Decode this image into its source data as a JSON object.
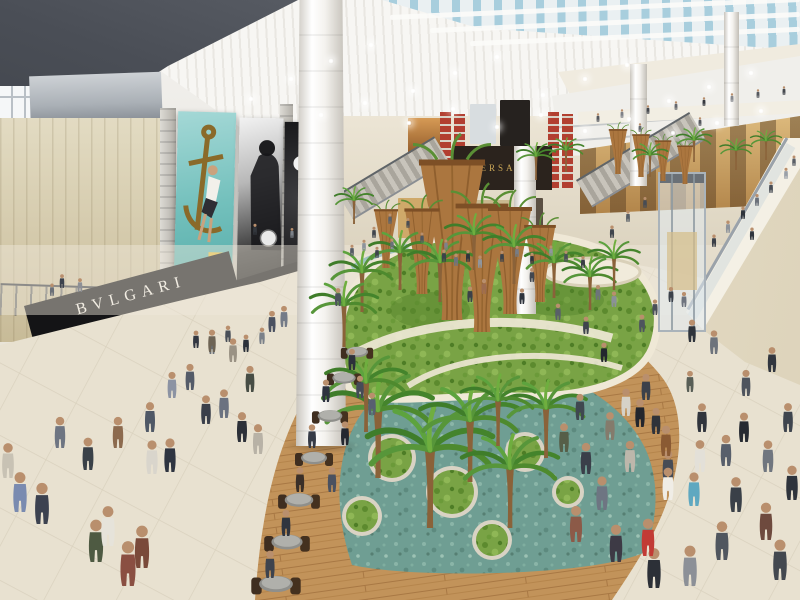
{
  "signs": {
    "bulgari": "BVLGARI",
    "veuve_clicquot": "Veuve Clicquot",
    "versace": "VERSACE"
  },
  "palette": {
    "ceiling_white": "#f4f3f0",
    "skylight_blue": "#a8cedd",
    "wall_beige": "#d9cfae",
    "fascia_black": "#141417",
    "store_glow_gold": "#dcb266",
    "garden_green": "#79a345",
    "water_teal": "#6f9e93",
    "deck_wood": "#c2935a",
    "floor_tile": "#e8e1d0",
    "cone_wood": "#ab763f",
    "versace_gold": "#c9a657",
    "banner_red": "#b23f30",
    "billboard_teal": "#73c0bc"
  },
  "sprites": {
    "lights": [
      [
        248,
        96
      ],
      [
        288,
        76
      ],
      [
        328,
        58
      ],
      [
        368,
        42
      ],
      [
        410,
        88
      ],
      [
        452,
        70
      ],
      [
        494,
        54
      ],
      [
        540,
        92
      ],
      [
        582,
        76
      ],
      [
        624,
        62
      ],
      [
        666,
        98
      ],
      [
        706,
        84
      ],
      [
        748,
        70
      ],
      [
        318,
        112
      ],
      [
        362,
        100
      ],
      [
        406,
        120
      ],
      [
        450,
        106
      ],
      [
        494,
        124
      ],
      [
        538,
        112
      ],
      [
        582,
        128
      ],
      [
        626,
        116
      ],
      [
        670,
        130
      ],
      [
        714,
        120
      ],
      [
        758,
        108
      ]
    ],
    "cones": [
      [
        452,
        320,
        1.5
      ],
      [
        482,
        332,
        1.2
      ],
      [
        510,
        314,
        1.0
      ],
      [
        422,
        294,
        0.8
      ],
      [
        540,
        302,
        0.72
      ],
      [
        386,
        268,
        0.55
      ],
      [
        618,
        174,
        0.42
      ],
      [
        641,
        177,
        0.4
      ],
      [
        663,
        181,
        0.38
      ],
      [
        685,
        184,
        0.36
      ]
    ],
    "palms": [
      [
        378,
        478,
        1.7
      ],
      [
        366,
        432,
        1.25
      ],
      [
        430,
        528,
        1.95
      ],
      [
        470,
        482,
        1.55
      ],
      [
        510,
        528,
        1.5
      ],
      [
        546,
        458,
        1.25
      ],
      [
        498,
        446,
        1.15
      ],
      [
        362,
        312,
        1.0
      ],
      [
        400,
        290,
        0.95
      ],
      [
        440,
        302,
        1.0
      ],
      [
        474,
        270,
        0.9
      ],
      [
        514,
        284,
        0.95
      ],
      [
        554,
        298,
        0.9
      ],
      [
        590,
        310,
        0.85
      ],
      [
        614,
        290,
        0.8
      ],
      [
        344,
        347,
        1.05
      ],
      [
        536,
        180,
        0.6
      ],
      [
        566,
        172,
        0.55
      ],
      [
        650,
        177,
        0.55
      ],
      [
        694,
        162,
        0.55
      ],
      [
        736,
        170,
        0.5
      ],
      [
        354,
        224,
        0.6
      ],
      [
        766,
        160,
        0.48
      ]
    ],
    "tables": [
      [
        357,
        352,
        0.85
      ],
      [
        344,
        378,
        0.9
      ],
      [
        330,
        416,
        0.95
      ],
      [
        314,
        458,
        1.0
      ],
      [
        299,
        500,
        1.1
      ],
      [
        287,
        542,
        1.2
      ],
      [
        276,
        584,
        1.3
      ]
    ],
    "people": [
      [
        62,
        288,
        0.55,
        "#3c424d"
      ],
      [
        80,
        292,
        0.55,
        "#8d8f95"
      ],
      [
        52,
        296,
        0.5,
        "#6b7078"
      ],
      [
        255,
        235,
        0.45,
        "#33373d"
      ],
      [
        408,
        228,
        0.4,
        "#4a4e54"
      ],
      [
        292,
        238,
        0.4,
        "#7c8188"
      ],
      [
        598,
        122,
        0.35,
        "#55585e"
      ],
      [
        622,
        118,
        0.35,
        "#7e8187"
      ],
      [
        648,
        114,
        0.35,
        "#45484e"
      ],
      [
        676,
        110,
        0.35,
        "#65686e"
      ],
      [
        704,
        106,
        0.35,
        "#35383e"
      ],
      [
        732,
        102,
        0.35,
        "#85888e"
      ],
      [
        758,
        98,
        0.35,
        "#55585e"
      ],
      [
        784,
        95,
        0.35,
        "#45484e"
      ],
      [
        640,
        132,
        0.35,
        "#666a70"
      ],
      [
        700,
        126,
        0.35,
        "#54575d"
      ],
      [
        714,
        247,
        0.5,
        "#3a3f47"
      ],
      [
        728,
        233,
        0.5,
        "#8d939b"
      ],
      [
        743,
        219,
        0.5,
        "#2e333b"
      ],
      [
        757,
        206,
        0.48,
        "#6a707a"
      ],
      [
        771,
        193,
        0.46,
        "#484d55"
      ],
      [
        786,
        179,
        0.45,
        "#9aa0a8"
      ],
      [
        752,
        240,
        0.5,
        "#30353d"
      ],
      [
        794,
        166,
        0.42,
        "#5a5f67"
      ],
      [
        352,
        256,
        0.45,
        "#555b64"
      ],
      [
        364,
        251,
        0.45,
        "#8d939b"
      ],
      [
        377,
        258,
        0.45,
        "#3e434b"
      ],
      [
        392,
        249,
        0.42,
        "#6a707a"
      ],
      [
        422,
        243,
        0.42,
        "#50555e"
      ],
      [
        446,
        250,
        0.42,
        "#7d838c"
      ],
      [
        502,
        262,
        0.45,
        "#3c414a"
      ],
      [
        517,
        257,
        0.45,
        "#777d86"
      ],
      [
        532,
        264,
        0.45,
        "#2f343c"
      ],
      [
        551,
        256,
        0.42,
        "#8f959d"
      ],
      [
        566,
        262,
        0.45,
        "#4a4f58"
      ],
      [
        583,
        268,
        0.48,
        "#383d45"
      ],
      [
        374,
        238,
        0.45,
        "#40454d"
      ],
      [
        390,
        224,
        0.42,
        "#5c626a"
      ],
      [
        612,
        238,
        0.5,
        "#3f444c"
      ],
      [
        628,
        222,
        0.46,
        "#585e66"
      ],
      [
        645,
        208,
        0.44,
        "#474c54"
      ],
      [
        671,
        302,
        0.6,
        "#3c424b"
      ],
      [
        684,
        307,
        0.6,
        "#6e747e"
      ],
      [
        655,
        315,
        0.62,
        "#4a505a"
      ],
      [
        196,
        348,
        0.7,
        "#323741"
      ],
      [
        212,
        354,
        0.7,
        "#6a7078"
      ],
      [
        228,
        342,
        0.66,
        "#494f58"
      ],
      [
        246,
        352,
        0.7,
        "#2c3139"
      ],
      [
        262,
        344,
        0.66,
        "#7b8189"
      ],
      [
        20,
        512,
        1.6,
        "#7a8bb0"
      ],
      [
        42,
        524,
        1.65,
        "#3c4250"
      ],
      [
        8,
        478,
        1.4,
        "#c8c2b4"
      ],
      [
        96,
        562,
        1.7,
        "#4e5a42"
      ],
      [
        128,
        586,
        1.8,
        "#8a4f42"
      ],
      [
        152,
        474,
        1.35,
        "#d9d5cc"
      ],
      [
        170,
        472,
        1.35,
        "#2e3440"
      ],
      [
        206,
        424,
        1.15,
        "#3a3f4a"
      ],
      [
        224,
        418,
        1.15,
        "#6b7280"
      ],
      [
        172,
        398,
        1.05,
        "#8c93a3"
      ],
      [
        190,
        390,
        1.05,
        "#545b68"
      ],
      [
        242,
        442,
        1.2,
        "#2c3038"
      ],
      [
        258,
        454,
        1.2,
        "#b8b2a6"
      ],
      [
        250,
        392,
        1.05,
        "#474d45"
      ],
      [
        233,
        362,
        0.95,
        "#9a9284"
      ],
      [
        212,
        352,
        0.9,
        "#6e6455"
      ],
      [
        272,
        332,
        0.85,
        "#4a5160"
      ],
      [
        284,
        327,
        0.85,
        "#747b88"
      ],
      [
        150,
        432,
        1.2,
        "#4f5866"
      ],
      [
        118,
        448,
        1.25,
        "#8c6a4e"
      ],
      [
        88,
        470,
        1.3,
        "#3a4148"
      ],
      [
        60,
        448,
        1.25,
        "#6e7582"
      ],
      [
        108,
        546,
        1.6,
        "#e6e3da"
      ],
      [
        142,
        568,
        1.7,
        "#7a4a3a"
      ],
      [
        326,
        402,
        0.9,
        "#2e3340"
      ],
      [
        360,
        398,
        0.9,
        "#454b58"
      ],
      [
        312,
        448,
        0.95,
        "#353a46"
      ],
      [
        345,
        445,
        0.95,
        "#23272f"
      ],
      [
        300,
        492,
        1.0,
        "#3a2f28"
      ],
      [
        332,
        492,
        1.0,
        "#4a5160"
      ],
      [
        286,
        536,
        1.05,
        "#30353f"
      ],
      [
        270,
        578,
        1.1,
        "#3d434e"
      ],
      [
        352,
        370,
        0.85,
        "#2c313b"
      ],
      [
        372,
        415,
        0.9,
        "#586070"
      ],
      [
        470,
        302,
        0.62,
        "#3b4048"
      ],
      [
        484,
        294,
        0.6,
        "#9c6b4f"
      ],
      [
        522,
        304,
        0.62,
        "#2e333b"
      ],
      [
        558,
        320,
        0.66,
        "#595f69"
      ],
      [
        586,
        334,
        0.7,
        "#3f444d"
      ],
      [
        604,
        362,
        0.78,
        "#23272e"
      ],
      [
        614,
        307,
        0.62,
        "#8a9099"
      ],
      [
        642,
        332,
        0.7,
        "#4e545e"
      ],
      [
        690,
        392,
        0.85,
        "#585e56"
      ],
      [
        656,
        434,
        1.05,
        "#2f333a"
      ],
      [
        598,
        300,
        0.6,
        "#6d737b"
      ],
      [
        532,
        282,
        0.56,
        "#42474f"
      ],
      [
        444,
        262,
        0.5,
        "#3d4249"
      ],
      [
        456,
        266,
        0.5,
        "#6e747c"
      ],
      [
        468,
        262,
        0.48,
        "#2f343b"
      ],
      [
        480,
        268,
        0.5,
        "#8f959d"
      ],
      [
        586,
        474,
        1.25,
        "#3a3f49"
      ],
      [
        602,
        510,
        1.35,
        "#6e7582"
      ],
      [
        576,
        542,
        1.45,
        "#8c5a48"
      ],
      [
        616,
        562,
        1.5,
        "#3d3a45"
      ],
      [
        654,
        588,
        1.6,
        "#2c3037"
      ],
      [
        630,
        472,
        1.25,
        "#bdb7ab"
      ],
      [
        668,
        482,
        1.28,
        "#474c55"
      ],
      [
        666,
        456,
        1.22,
        "#8a5a33"
      ],
      [
        702,
        432,
        1.15,
        "#30343c"
      ],
      [
        726,
        466,
        1.25,
        "#585f6b"
      ],
      [
        744,
        442,
        1.18,
        "#262a31"
      ],
      [
        768,
        472,
        1.27,
        "#70767f"
      ],
      [
        788,
        432,
        1.16,
        "#3f454e"
      ],
      [
        746,
        396,
        1.05,
        "#4e545d"
      ],
      [
        772,
        372,
        1.0,
        "#31363e"
      ],
      [
        714,
        354,
        0.95,
        "#6d737c"
      ],
      [
        692,
        342,
        0.9,
        "#2f343b"
      ],
      [
        626,
        416,
        1.1,
        "#d6d2c8"
      ],
      [
        646,
        400,
        1.05,
        "#3c414a"
      ],
      [
        640,
        427,
        1.12,
        "#23262d"
      ],
      [
        694,
        506,
        1.35,
        "#5fa8c0"
      ],
      [
        700,
        472,
        1.28,
        "#e3e0d8"
      ],
      [
        648,
        556,
        1.5,
        "#c23b35"
      ],
      [
        610,
        440,
        1.12,
        "#847b6c"
      ],
      [
        580,
        420,
        1.05,
        "#3f4750"
      ],
      [
        564,
        452,
        1.15,
        "#565e48"
      ],
      [
        736,
        512,
        1.4,
        "#3a4048"
      ],
      [
        766,
        540,
        1.5,
        "#6e4a3e"
      ],
      [
        792,
        500,
        1.38,
        "#2f343c"
      ],
      [
        722,
        560,
        1.55,
        "#50565f"
      ],
      [
        690,
        586,
        1.62,
        "#8c9097"
      ],
      [
        780,
        580,
        1.62,
        "#43484f"
      ],
      [
        668,
        500,
        1.3,
        "#f0ede6"
      ],
      [
        338,
        306,
        0.72,
        "#4c525c"
      ]
    ]
  }
}
